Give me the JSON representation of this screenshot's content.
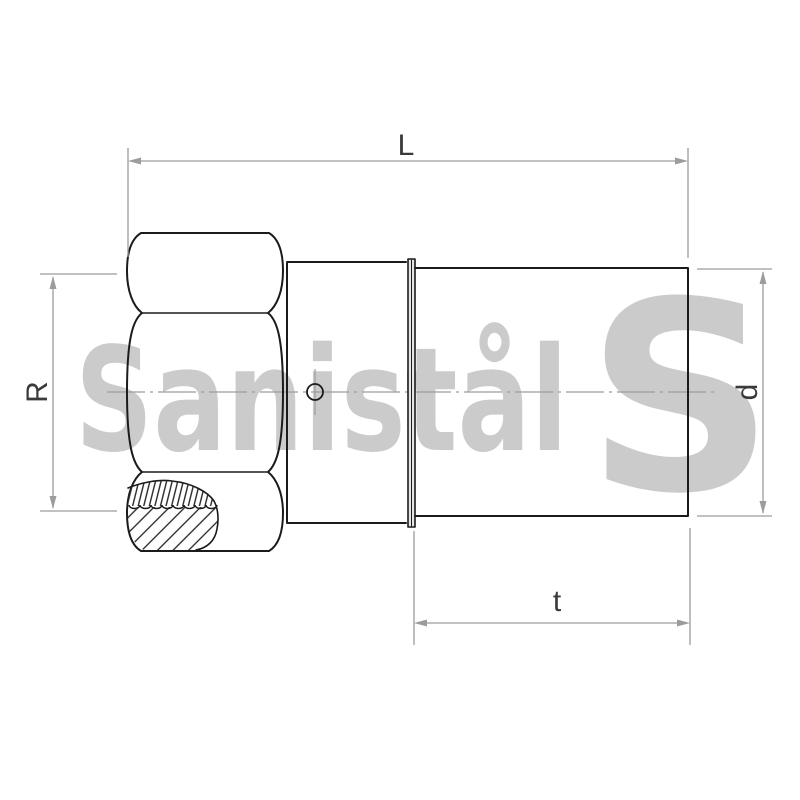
{
  "watermark": {
    "brand_text": "Sanistål",
    "logo_letter": "S",
    "color": "#cbcbcb"
  },
  "dimension_labels": {
    "length": "L",
    "thread": "R",
    "outer_diameter": "d",
    "pipe_length": "t"
  },
  "colors": {
    "outline": "#1b1b1b",
    "dimension_line": "#9c9c9c",
    "label_text": "#3a3a3a",
    "background": "#ffffff"
  }
}
